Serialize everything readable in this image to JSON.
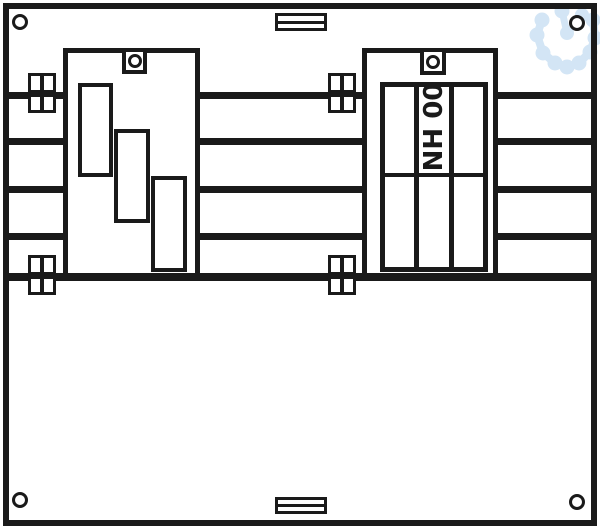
{
  "diagram": {
    "type": "electrical-distribution-panel-drawing",
    "fuse_label": "NH 00",
    "colors": {
      "line": "#1a1a1a",
      "background": "#ffffff",
      "watermark": "#cfe3f4"
    },
    "icons": [
      "mounting-hole-icon",
      "terminal-clamp-icon",
      "cable-flange-icon",
      "fixing-tab-icon",
      "watermark-gear-icon"
    ]
  }
}
